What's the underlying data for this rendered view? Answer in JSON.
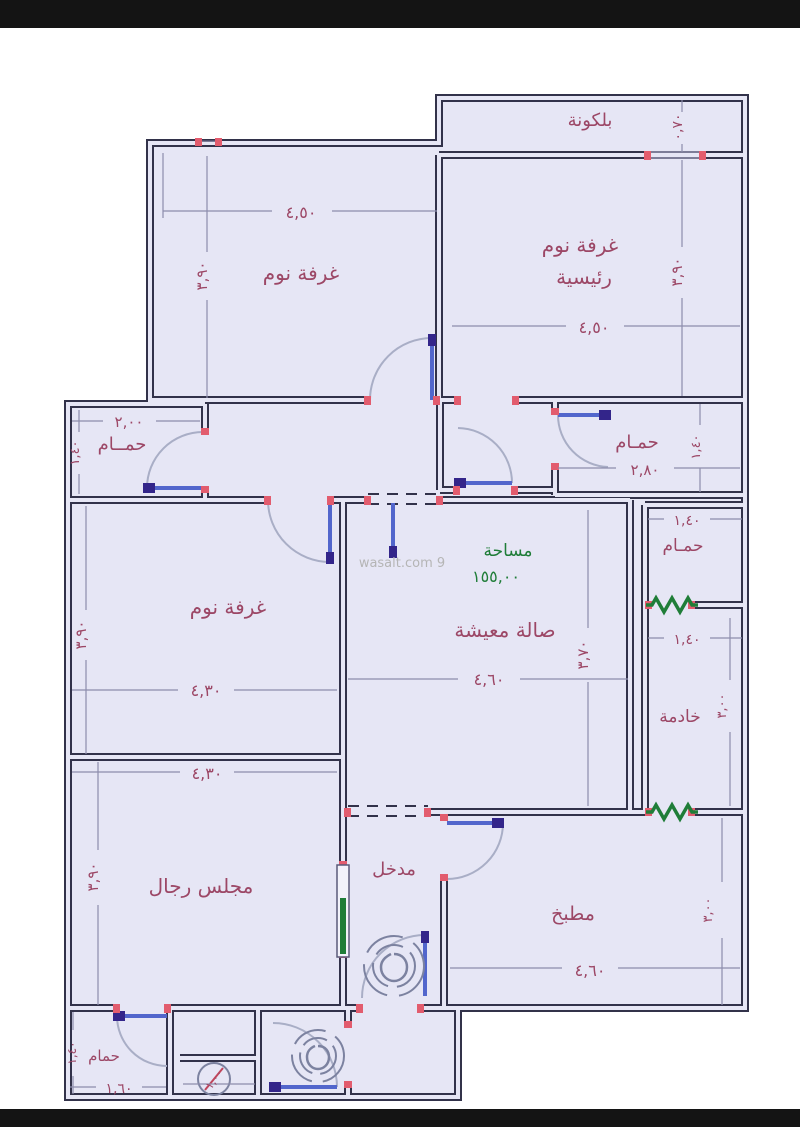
{
  "watermark": "wasalt.com 9",
  "area_note": {
    "title": "مساحة",
    "value": "١٥٥,٠٠"
  },
  "rooms": {
    "balcony": {
      "name": "بلكونة",
      "depth": "٠,٧٠"
    },
    "bedroom_top": {
      "name": "غرفة نوم",
      "width": "٤,٥٠",
      "height": "٣,٩٠"
    },
    "master_bedroom": {
      "name_line1": "غرفة نوم",
      "name_line2": "رئيسية",
      "width": "٤,٥٠",
      "height": "٣,٩٠"
    },
    "bath_left": {
      "name": "حمــام",
      "width": "٢,٠٠",
      "height": "١,٤٠"
    },
    "bath_hall": {
      "name": "حمـام",
      "width": "٢,٨٠",
      "height": "١,٤٠"
    },
    "bedroom_left": {
      "name": "غرفة نوم",
      "width": "٤,٣٠",
      "height": "٣,٩٠"
    },
    "living": {
      "name": "صالة معيشة",
      "width": "٤,٦٠",
      "height": "٣,٧٠"
    },
    "bath_right": {
      "name": "حمـام",
      "width": "١,٤٠"
    },
    "maid": {
      "name": "خادمة",
      "width": "١,٤٠",
      "height": "٣,٠٠"
    },
    "majlis": {
      "name": "مجلس رجال",
      "width": "٤,٣٠",
      "height": "٣,٩٠"
    },
    "entrance": {
      "name": "مدخل"
    },
    "kitchen": {
      "name": "مطبخ",
      "width": "٤,٦٠",
      "height": "٣,٠٠"
    },
    "bath_bottom": {
      "name": "حمام",
      "width": "١,٦٠",
      "height": "١,٤٠"
    },
    "basin": {
      "width": "١,٠٠"
    }
  },
  "colors": {
    "wall": "#32324a",
    "floor": "#e6e6f5",
    "label": "#9c4766",
    "green": "#1f7d38",
    "door": "#5266cc",
    "door_cap": "#33258a",
    "jamb": "#e25c6e",
    "arc": "#a9aec6",
    "dim_line": "#8d8dac",
    "watermark": "#b5b5b5",
    "letterbox": "#141414"
  }
}
